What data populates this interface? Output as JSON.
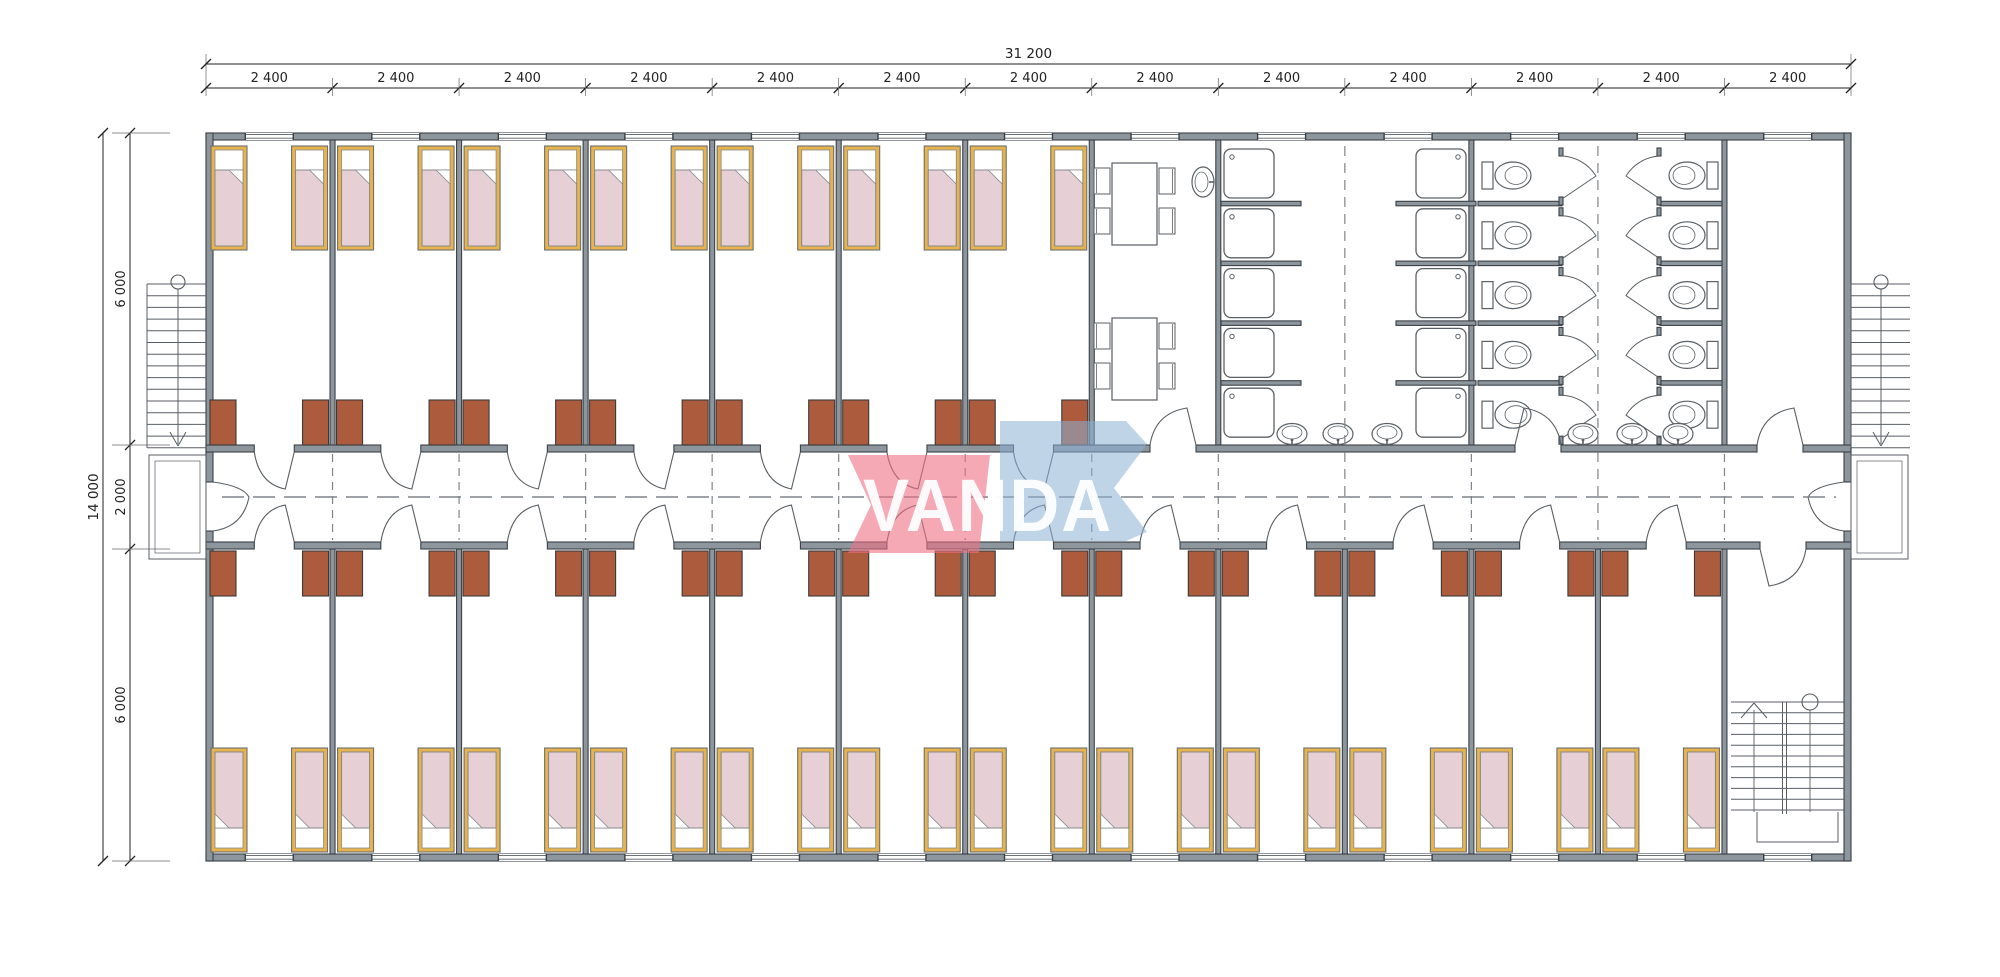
{
  "document": {
    "type": "architectural-floor-plan",
    "subject": "modular container dormitory building - floor plan",
    "units": "mm"
  },
  "logo": {
    "text": "VANDA",
    "banner_red": "#ee6f84",
    "banner_blue": "#8cb0d6",
    "text_color": "#ffffff"
  },
  "dimensions": {
    "top": {
      "overall": "31 200",
      "bay_labels": [
        "2 400",
        "2 400",
        "2 400",
        "2 400",
        "2 400",
        "2 400",
        "2 400",
        "2 400",
        "2 400",
        "2 400",
        "2 400",
        "2 400",
        "2 400"
      ]
    },
    "left": {
      "overall": "14 000",
      "segments": [
        "6 000",
        "2 000",
        "6 000"
      ]
    }
  },
  "layout": {
    "bay_count": 13,
    "corridor": {
      "position": "center",
      "width_label": "2 000"
    },
    "rooms": [
      {
        "name": "bedroom-top-row",
        "count": 7,
        "beds_each": 2,
        "wardrobes_each": 2
      },
      {
        "name": "bedroom-bottom-row",
        "count": 12,
        "beds_each": 2,
        "wardrobes_each": 2
      },
      {
        "name": "dining-room",
        "tables": 2,
        "chairs_per_table": 4,
        "wall_sinks": 1
      },
      {
        "name": "washroom",
        "showers": 10,
        "toilets": 10,
        "wall_sinks": 6
      },
      {
        "name": "storage-room",
        "count": 1
      },
      {
        "name": "stair-room",
        "count": 1
      }
    ],
    "stairs": [
      "external-stair-left",
      "external-stair-right",
      "internal-stair"
    ],
    "totals": {
      "beds": 38,
      "wardrobes": 38,
      "showers": 10,
      "toilets": 10,
      "sinks": 7,
      "tables": 2,
      "chairs": 8,
      "windows": 26,
      "room_doors": 23,
      "exit_doors": 2
    }
  },
  "colors": {
    "wall": "#8e969d",
    "wall_stroke": "#3a4046",
    "line": "#585e63",
    "dash": "#7e848a",
    "bed_frame": "#e7b34c",
    "bed_frame_stroke": "#6d6f71",
    "blanket": "#e6d0d6",
    "blanket_stroke": "#85898d",
    "pillow": "#ffffff",
    "wardrobe": "#ac5c3d",
    "wardrobe_stroke": "#3a3a3a",
    "fixture_stroke": "#5a6065",
    "dim_text": "#222222",
    "background": "#ffffff"
  }
}
